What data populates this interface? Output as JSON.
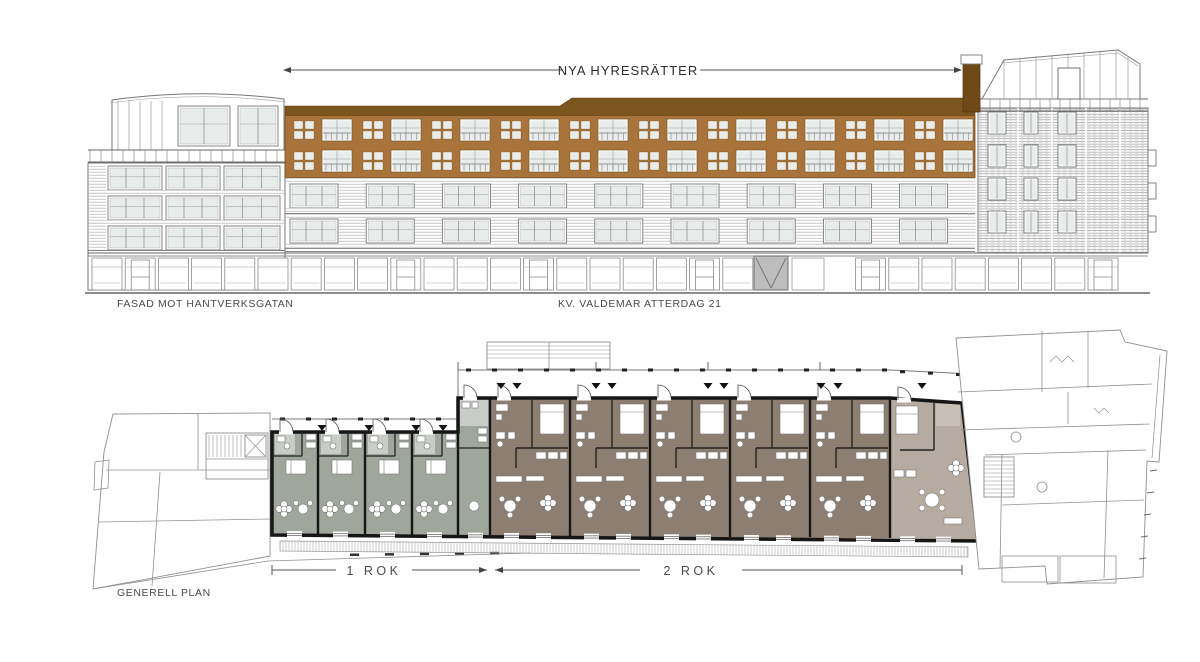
{
  "drawing": {
    "title_annotation": "NYA HYRESRÄTTER",
    "facade_caption": "FASAD MOT HANTVERKSGATAN",
    "block_caption": "KV. VALDEMAR ATTERDAG 21",
    "plan_caption": "GENERELL PLAN",
    "dim_label_left": "1 ROK",
    "dim_label_right": "2 ROK"
  },
  "colors": {
    "addition_wall": "#A9743C",
    "addition_roof": "#7C551E",
    "addition_roof_dark": "#6F4A18",
    "window_glass": "#E8ECEA",
    "line_dark": "#555555",
    "line_mid": "#777777",
    "line_light": "#9a9a9a",
    "plan_wall": "#161616",
    "floor_1rok": "#9FA69B",
    "floor_2rok": "#8C7F72",
    "floor_end_unit": "#B5ABA0",
    "floor_bath": "#C9CDC7",
    "gate_gray": "#BDBDBD"
  },
  "facade": {
    "addition_window_bays": 10,
    "existing_window_groups": 9,
    "right_tower_rows": 4
  },
  "plan": {
    "units_1rok": 4,
    "units_2rok": 5,
    "end_units": 1
  }
}
